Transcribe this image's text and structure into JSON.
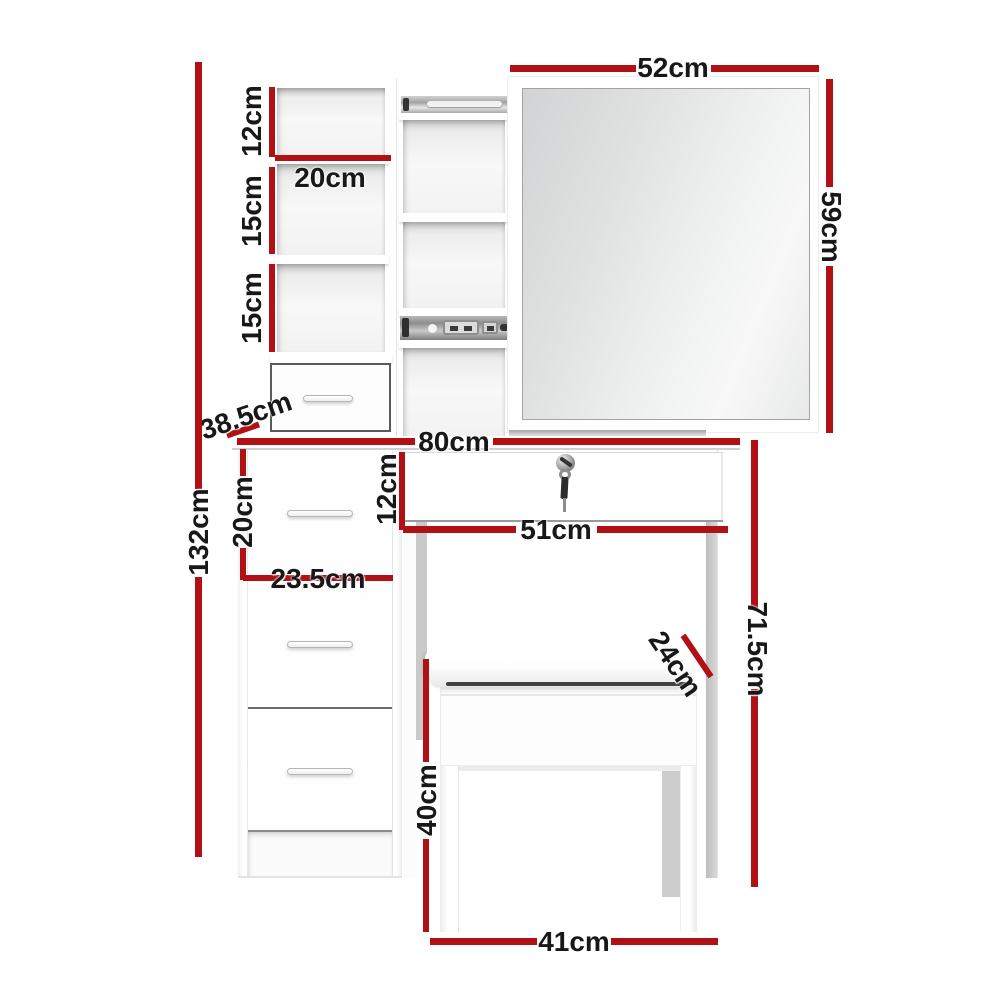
{
  "colors": {
    "dimension_line": "#b11014",
    "label_text": "#181818",
    "furniture": "#ffffff",
    "shadow_gray": "#c9c9c9",
    "mirror_glass": "#e4e5e5"
  },
  "dimensions": {
    "mirror_width": "52cm",
    "mirror_height": "59cm",
    "top_shelf_height": "12cm",
    "shelf_width": "20cm",
    "middle_shelf_height": "15cm",
    "lower_shelf_height": "15cm",
    "cabinet_depth": "38.5cm",
    "overall_height": "132cm",
    "tabletop_width": "80cm",
    "side_drawer_height": "20cm",
    "side_drawer_width": "23.5cm",
    "center_drawer_height": "12cm",
    "center_drawer_width": "51cm",
    "knee_space_height": "71.5cm",
    "stool_seat_depth": "24cm",
    "stool_leg_height": "40cm",
    "stool_width": "41cm"
  }
}
